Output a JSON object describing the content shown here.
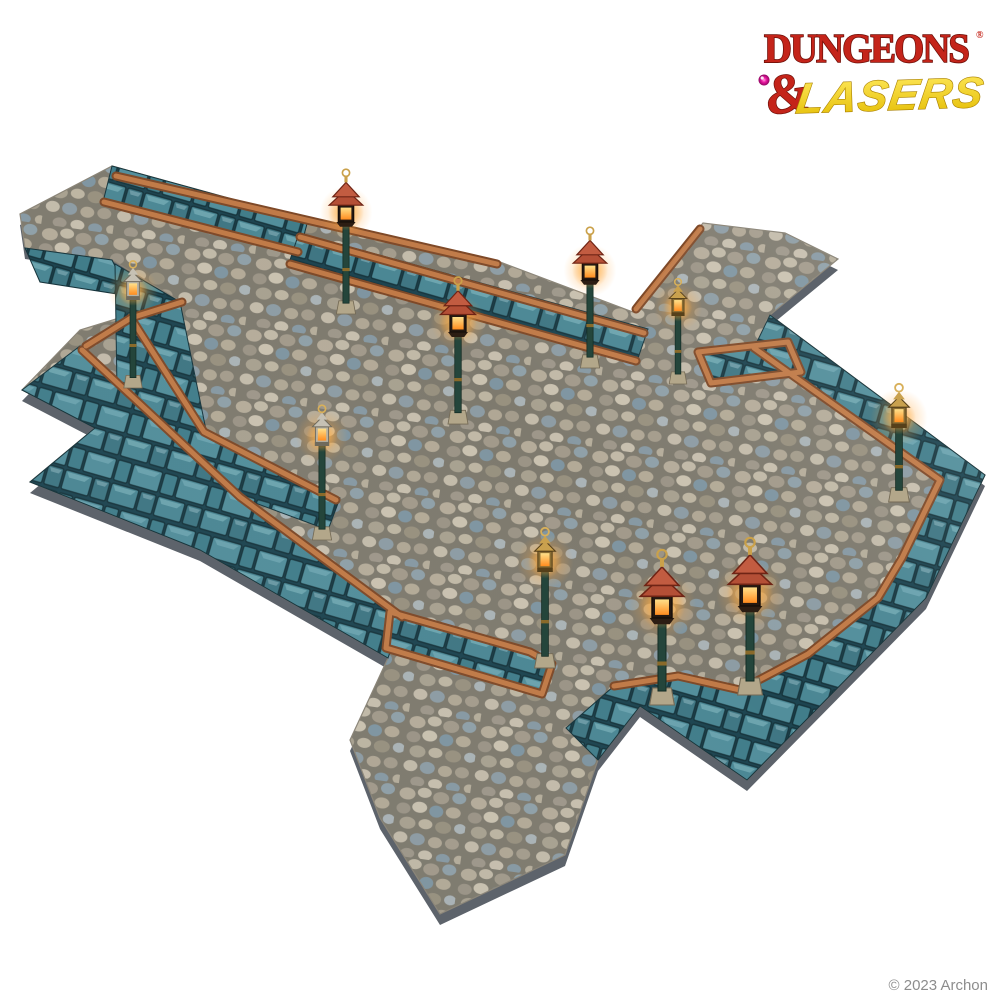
{
  "page": {
    "background": "#ffffff"
  },
  "logo": {
    "word1": "DUNGEONS",
    "registered": "®",
    "ampersand": "&",
    "word2": "LASERS"
  },
  "footer": {
    "copyright": "© 2023 Archon"
  },
  "colors": {
    "page_bg": "#ffffff",
    "brand_red": "#c4241a",
    "brand_red_outline": "#6e0f08",
    "brand_yellow": "#f6d412",
    "brand_yellow_dark": "#a87f00",
    "gem": "#e916a1",
    "copyright": "#8d8d8d",
    "cobble_grout": "#7e7a6e",
    "cobble_stone": "#b5ac9a",
    "cobble_blue_stone": "#7f95a1",
    "teal": "#4b8794",
    "teal_dark": "#16343c",
    "teal_light": "#a8d8de",
    "copper": "#c07a47",
    "copper_dark": "#7e4928",
    "base_plastic": "#5d636b",
    "pole_green": "#24453b",
    "stone_plinth": "#b3a78a",
    "lamp_red_roof": "#b44f36",
    "lamp_gold": "#c9a14e",
    "lamp_silver": "#b7b2a3",
    "glow_amber": "#ffb23e"
  },
  "scene": {
    "lamps": [
      {
        "id": 1,
        "x": 133,
        "head_y": 300,
        "base_y": 388,
        "style": "lantern-silver",
        "scale": 1.15
      },
      {
        "id": 2,
        "x": 346,
        "head_y": 222,
        "base_y": 314,
        "style": "pagoda-red",
        "scale": 1.2
      },
      {
        "id": 3,
        "x": 458,
        "head_y": 332,
        "base_y": 424,
        "style": "pagoda-red",
        "scale": 1.25
      },
      {
        "id": 4,
        "x": 590,
        "head_y": 280,
        "base_y": 368,
        "style": "pagoda-red",
        "scale": 1.2
      },
      {
        "id": 5,
        "x": 678,
        "head_y": 316,
        "base_y": 384,
        "style": "lantern-gold",
        "scale": 1.1
      },
      {
        "id": 6,
        "x": 899,
        "head_y": 428,
        "base_y": 502,
        "style": "lantern-gold",
        "scale": 1.3
      },
      {
        "id": 7,
        "x": 322,
        "head_y": 446,
        "base_y": 540,
        "style": "lantern-silver",
        "scale": 1.2
      },
      {
        "id": 8,
        "x": 545,
        "head_y": 572,
        "base_y": 668,
        "style": "lantern-gold",
        "scale": 1.3
      },
      {
        "id": 9,
        "x": 662,
        "head_y": 618,
        "base_y": 705,
        "style": "pagoda-red",
        "scale": 1.55
      },
      {
        "id": 10,
        "x": 750,
        "head_y": 606,
        "base_y": 695,
        "style": "pagoda-red",
        "scale": 1.55
      }
    ]
  }
}
